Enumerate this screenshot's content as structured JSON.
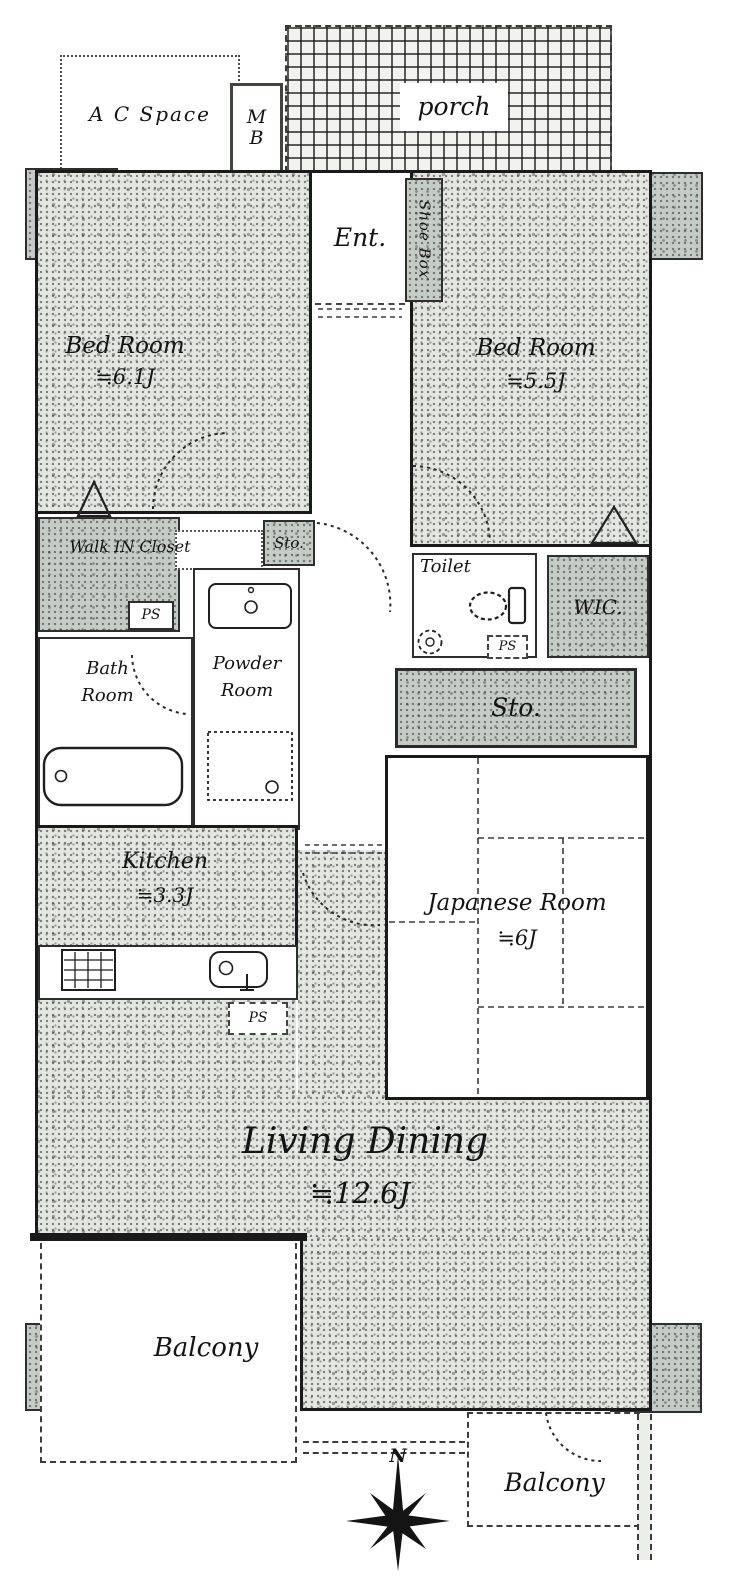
{
  "title": "Apartment floor plan",
  "colors": {
    "wall": "#1a1a1a",
    "room_fill": "#e3e6e1",
    "pillar_fill": "#c5ccc7",
    "paper": "#ffffff",
    "dashed_line": "#3c3c3c"
  },
  "top": {
    "ac_space": "A C Space",
    "meter_box_line1": "M",
    "meter_box_line2": "B",
    "porch": "porch"
  },
  "entrance": {
    "label": "Ent.",
    "shoe_box": "Shoe Box"
  },
  "rooms": {
    "bedroom1": {
      "name": "Bed Room",
      "size": "≒6.1J"
    },
    "bedroom2": {
      "name": "Bed Room",
      "size": "≒5.5J"
    },
    "walk_in_closet": "Walk IN Closet",
    "storage_small": "Sto.",
    "toilet": "Toilet",
    "wic": "WIC.",
    "storage_large": "Sto.",
    "bathroom": {
      "line1": "Bath",
      "line2": "Room"
    },
    "powder_room": {
      "line1": "Powder",
      "line2": "Room"
    },
    "kitchen": {
      "name": "Kitchen",
      "size": "≒3.3J"
    },
    "japanese_room": {
      "name": "Japanese Room",
      "size": "≒6J"
    },
    "living_dining": {
      "name": "Living Dining",
      "size": "≒12.6J"
    }
  },
  "utility": {
    "ps1": "PS",
    "ps2": "PS",
    "ps3": "PS"
  },
  "balconies": {
    "left": "Balcony",
    "right": "Balcony"
  },
  "compass": {
    "north": "N"
  }
}
